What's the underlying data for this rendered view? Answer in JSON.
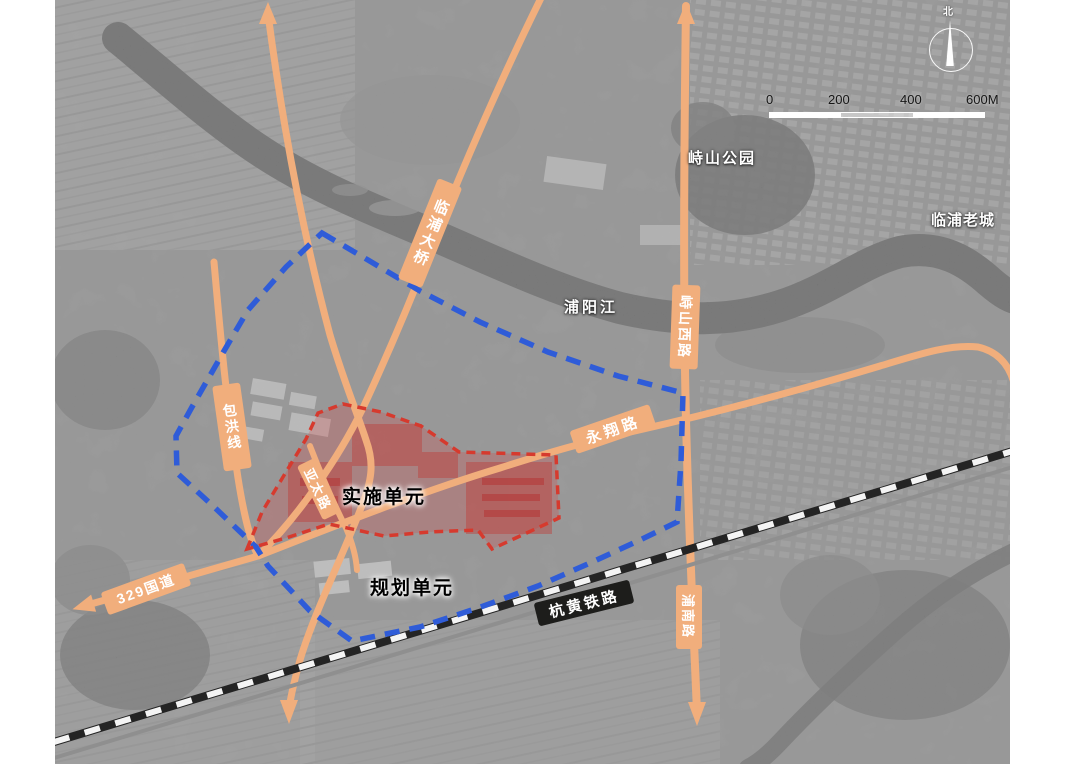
{
  "map": {
    "place_labels": {
      "park": "峙山公园",
      "old_town": "临浦老城",
      "river": "浦阳江"
    },
    "unit_labels": {
      "implementation": "实施单元",
      "planning": "规划单元"
    },
    "road_labels": {
      "linpu_bridge": "临浦大桥",
      "zhishan_west_road": "峙山西路",
      "yongxiang_road": "永翔路",
      "baohong_line": "包洪线",
      "g329": "329国道",
      "yatai_road": "亚太路",
      "punan_road": "浦南路",
      "hanghuang_railway": "杭黄铁路"
    },
    "scale_bar": {
      "ticks": [
        "0",
        "200",
        "400",
        "600M"
      ]
    },
    "compass": {
      "north_label": "北"
    },
    "legend_colors": {
      "road": "#f1ae7c",
      "railway_dark": "#1d1d1b",
      "planning_boundary": "#2f5cd8",
      "implementation_boundary": "#d63a2e",
      "implementation_fill": "#d64646"
    }
  }
}
